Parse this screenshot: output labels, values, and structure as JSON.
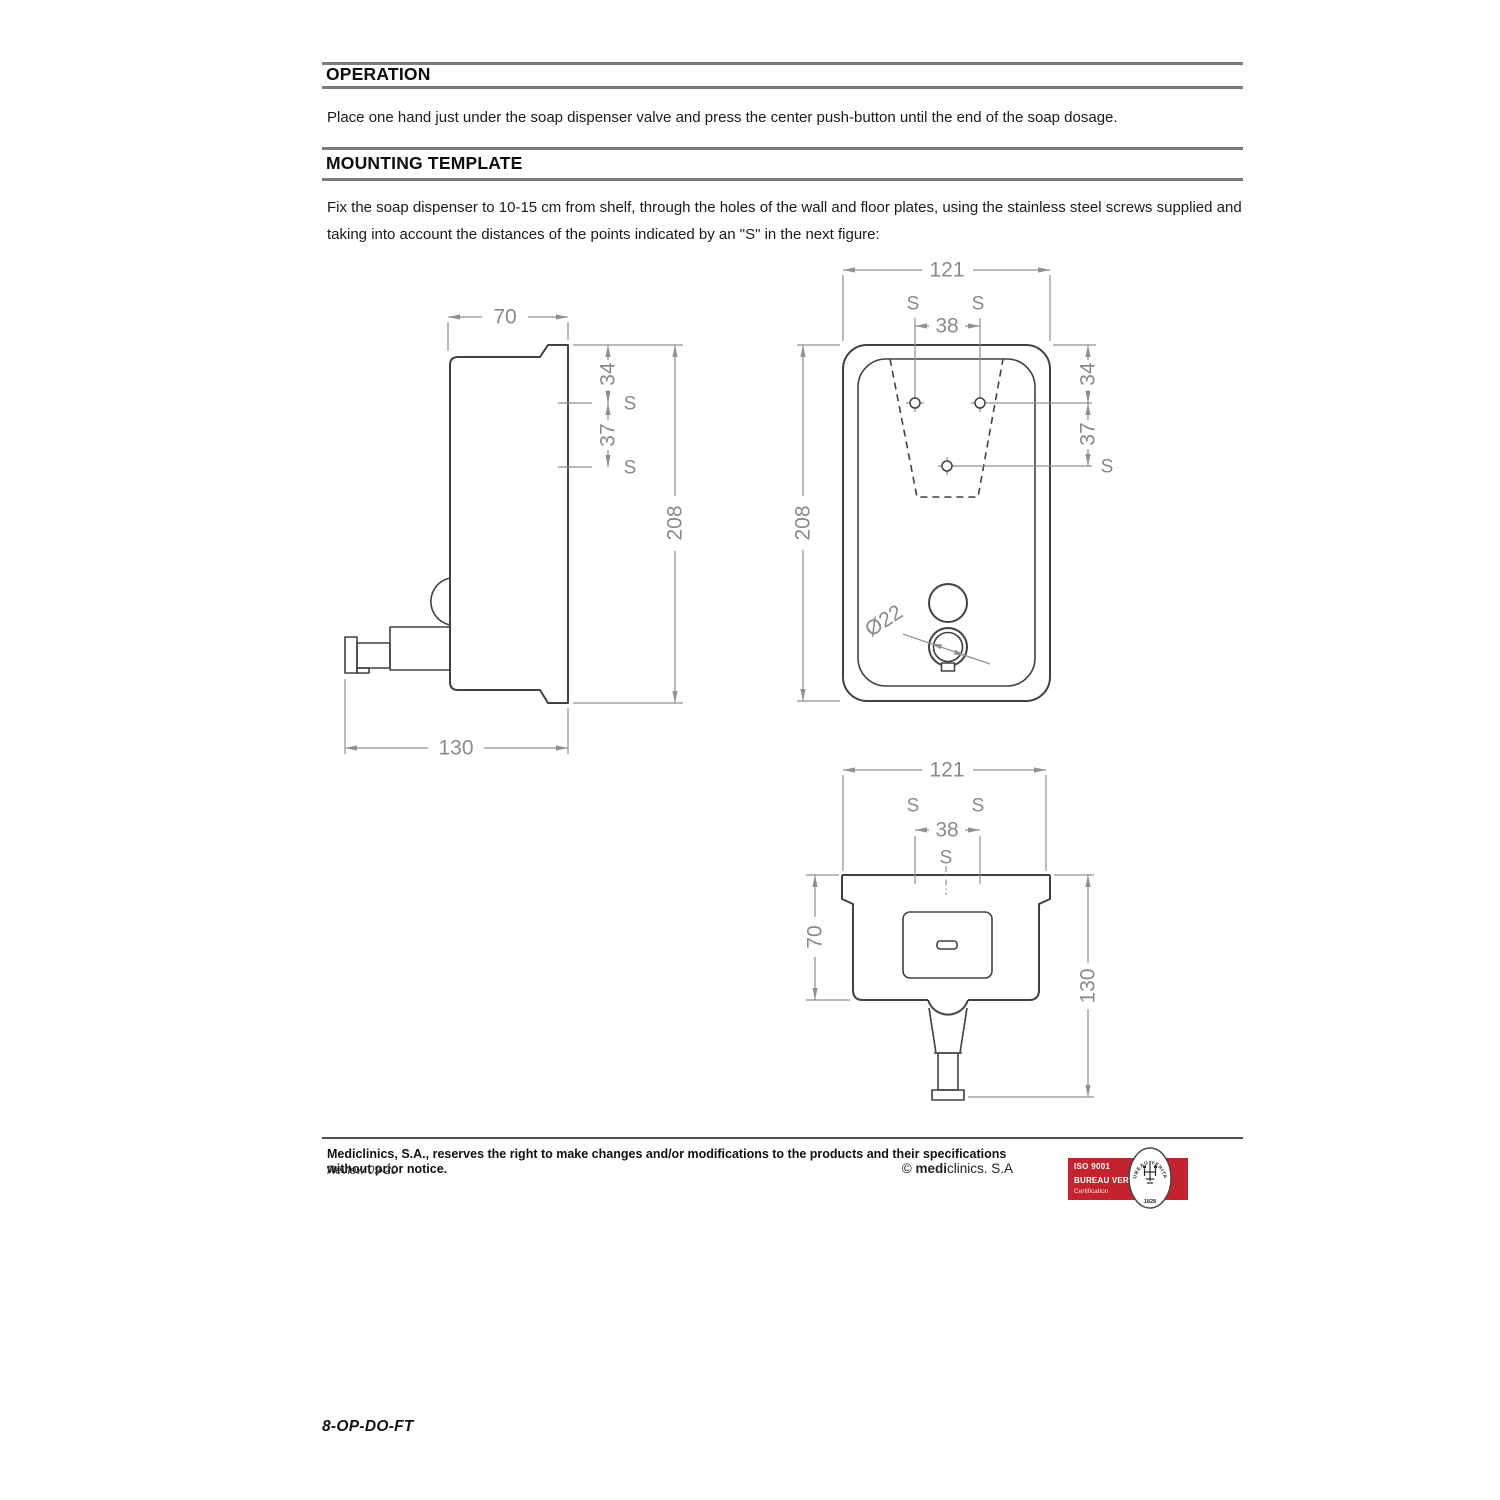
{
  "sections": {
    "operation": {
      "title": "OPERATION",
      "body": "Place one hand just under the soap dispenser valve and press the center push-button until the end of the soap dosage."
    },
    "mounting": {
      "title": "MOUNTING TEMPLATE",
      "body": "Fix the soap dispenser to 10-15 cm from shelf, through the holes of the wall and floor plates, using the stainless steel screws supplied and taking into account the distances of the points indicated by an \"S\" in the next figure:"
    }
  },
  "diagram": {
    "side_view": {
      "width": "70",
      "total_depth": "130",
      "height": "208",
      "top_to_hole": "34",
      "hole_pitch": "37",
      "screw_mark": "S"
    },
    "front_view": {
      "width": "121",
      "hole_gap": "38",
      "height": "208",
      "top_to_hole": "34",
      "hole_pitch": "37",
      "valve_diameter": "Ø22",
      "screw_mark": "S"
    },
    "top_view": {
      "width": "121",
      "hole_gap": "38",
      "body_depth": "70",
      "total_depth": "130",
      "screw_mark": "S"
    }
  },
  "footer": {
    "legal": "Mediclinics, S.A., reserves the right to make changes and/or modifications to the products and their specifications without prior notice.",
    "review": "Review 09-20",
    "copyright_symbol": "© ",
    "copyright_bold": "medi",
    "copyright_rest": "clinics. S.A",
    "certification": {
      "standard": "ISO 9001",
      "organization": "BUREAU VERITAS",
      "label": "Certification",
      "seal_text": "BUREAU VERITAS",
      "seal_year": "1828",
      "badge_color": "#c2232e"
    },
    "doc_code": "8-OP-DO-FT"
  }
}
